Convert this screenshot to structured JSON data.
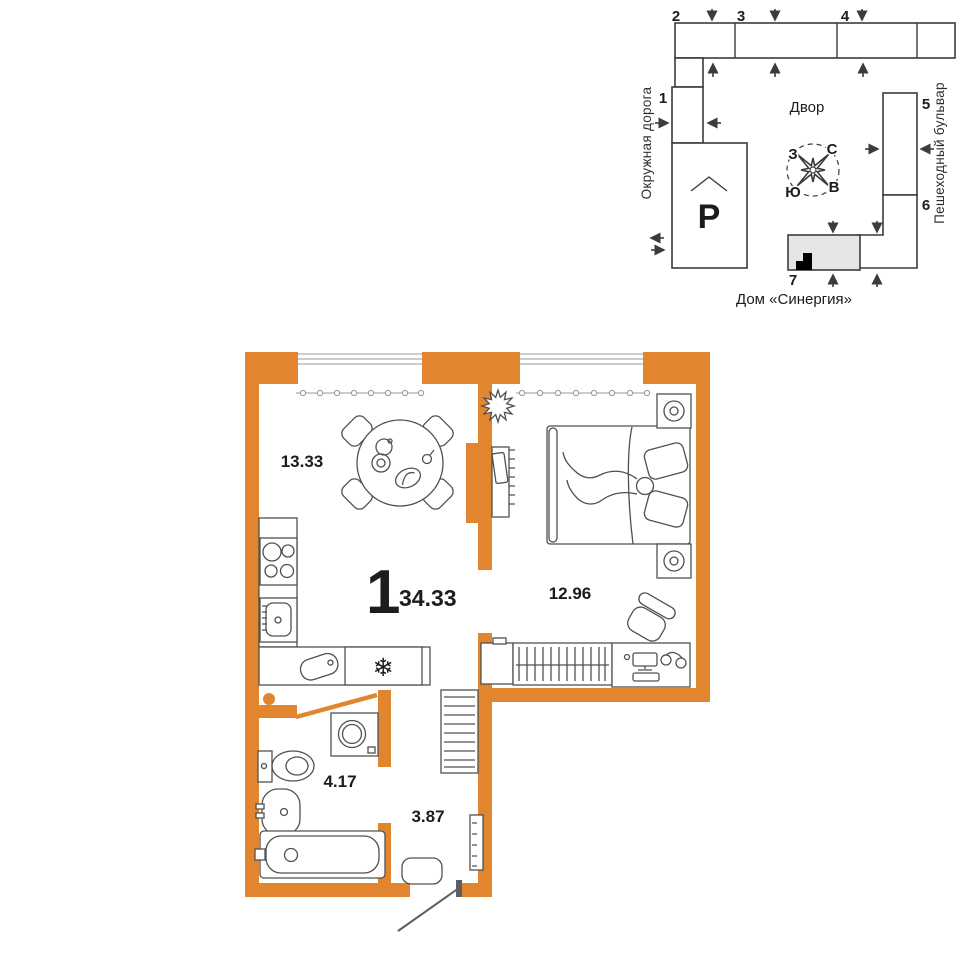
{
  "floor_plan": {
    "rooms_count": "1",
    "total_area": "34.33",
    "areas": {
      "kitchen_living": "13.33",
      "bedroom": "12.96",
      "bathroom": "4.17",
      "hallway": "3.87"
    }
  },
  "site_plan": {
    "courtyard": "Двор",
    "house_name": "Дом «Синергия»",
    "street_left": "Окружная дорога",
    "street_right": "Пешеходный бульвар",
    "parking": "P",
    "building_numbers": {
      "b1": "1",
      "b2": "2",
      "b3": "3",
      "b4": "4",
      "b5": "5",
      "b6": "6",
      "b7": "7"
    },
    "compass": {
      "north": "С",
      "south": "Ю",
      "east": "В",
      "west": "З"
    }
  },
  "icons": {
    "snowflake": "❄"
  },
  "colors": {
    "wall_orange": "#e1862f",
    "fridge_snowflake": "#4a90d8",
    "highlighted_building_fill": "#e6e6e6",
    "apartment_marker": "#000000"
  }
}
